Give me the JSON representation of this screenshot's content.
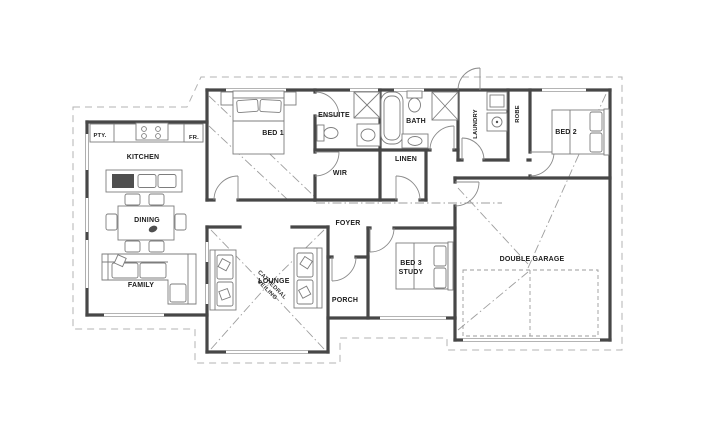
{
  "labels": {
    "pty": "PTY.",
    "kitchen": "KITCHEN",
    "fr": "FR.",
    "dining": "DINING",
    "family": "FAMILY",
    "lounge": "LOUNGE",
    "lounge_note_line1": "CATHEDRAL",
    "lounge_note_line2": "CEILING",
    "bed1": "BED 1",
    "ensuite": "ENSUITE",
    "wir": "WIR",
    "bath": "BATH",
    "linen": "LINEN",
    "laundry": "LAUNDRY",
    "robe": "ROBE",
    "bed2": "BED 2",
    "foyer": "FOYER",
    "porch": "PORCH",
    "bed3_line1": "BED 3",
    "bed3_line2": "STUDY",
    "garage": "DOUBLE GARAGE"
  },
  "colors": {
    "paper": "#ffffff",
    "wall": "#474747",
    "furniture": "#7d7d7d",
    "overhang": "#b3b3b3",
    "roofline": "#9e9e9e",
    "text": "#1c1c1c"
  }
}
